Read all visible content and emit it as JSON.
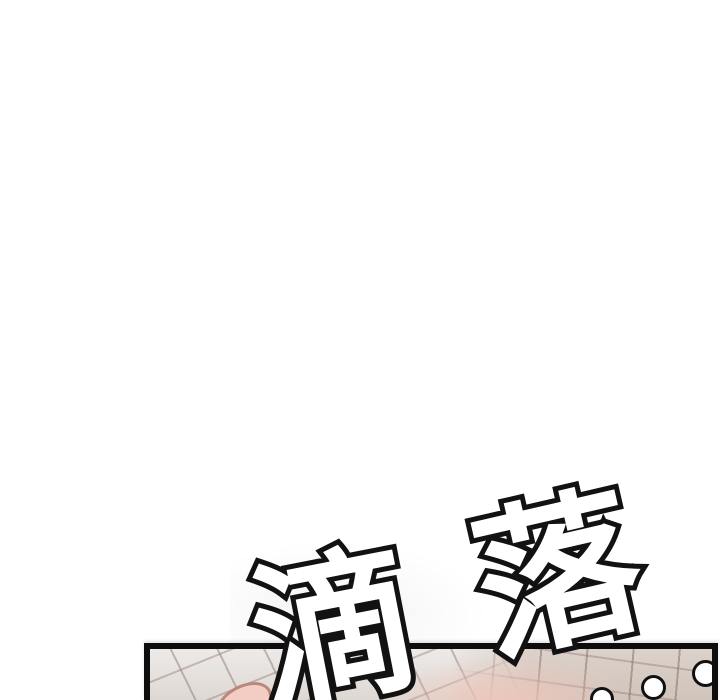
{
  "page": {
    "background_color": "#ffffff"
  },
  "sfx": {
    "text": "滴落",
    "chars": [
      "滴",
      "落"
    ],
    "trailing_dot_count": 3,
    "fill_color": "#ffffff",
    "outline_color": "#121212"
  },
  "panel": {
    "border_color": "#0d0d0d",
    "tile_base_color": "#e8e5e2",
    "tile_base_color_right": "#d0c4bb",
    "tile_grout_color": "#8a7068",
    "skin_tone_color": "#f3cdc3",
    "skin_outline_color": "#b9877b",
    "dot_fill_color": "#ffffff",
    "dot_outline_color": "#111111"
  }
}
